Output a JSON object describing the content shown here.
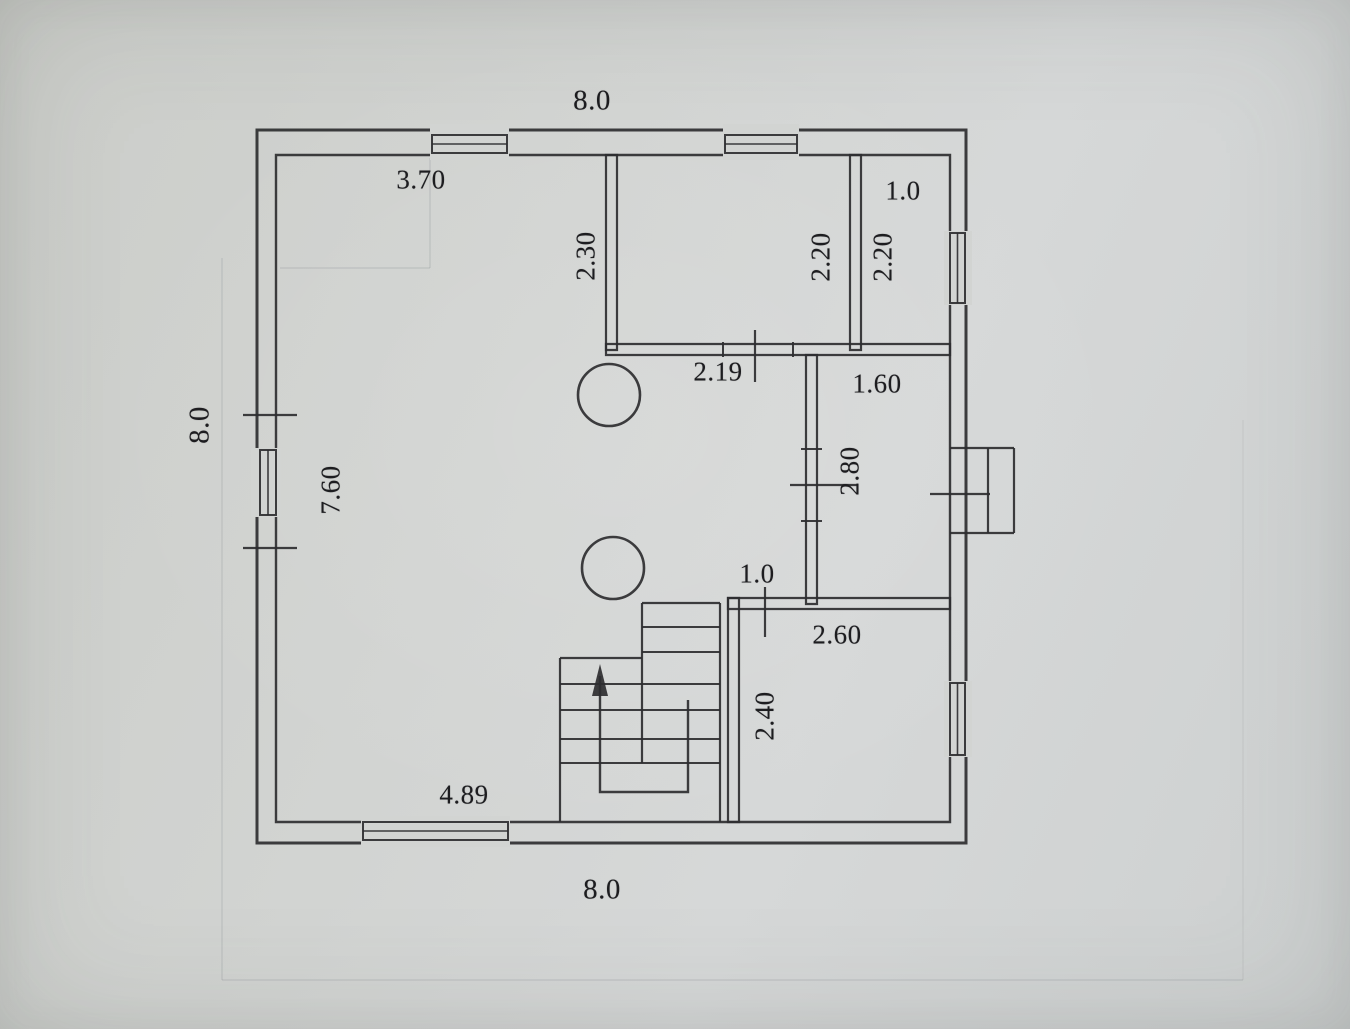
{
  "document": {
    "kind": "scanned floor plan drawing",
    "colors": {
      "paper": "#d2d4d2",
      "ink": "#2e2e30"
    }
  },
  "plan": {
    "labels": [
      {
        "id": "d00-overall-width-top",
        "text": "8.0"
      },
      {
        "id": "d01-top-left-room-width",
        "text": "3.70"
      },
      {
        "id": "d02-top-right-room-width",
        "text": "1.0"
      },
      {
        "id": "d03-partition-length",
        "text": "2.30"
      },
      {
        "id": "d04-top-mid-room-depth",
        "text": "2.20"
      },
      {
        "id": "d05-top-right-room-depth",
        "text": "2.20"
      },
      {
        "id": "d06-mid-room-width",
        "text": "2.19"
      },
      {
        "id": "d07-corridor-width",
        "text": "1.60"
      },
      {
        "id": "d08-overall-height-left",
        "text": "8.0"
      },
      {
        "id": "d09-left-room-length",
        "text": "7.60"
      },
      {
        "id": "d10-corridor-length",
        "text": "2.80"
      },
      {
        "id": "d11-passage-width",
        "text": "1.0"
      },
      {
        "id": "d12-bottom-right-room-width",
        "text": "2.60"
      },
      {
        "id": "d13-bottom-right-room-depth",
        "text": "2.40"
      },
      {
        "id": "d14-bottom-left-width",
        "text": "4.89"
      },
      {
        "id": "d15-overall-width-bottom",
        "text": "8.0"
      }
    ]
  }
}
